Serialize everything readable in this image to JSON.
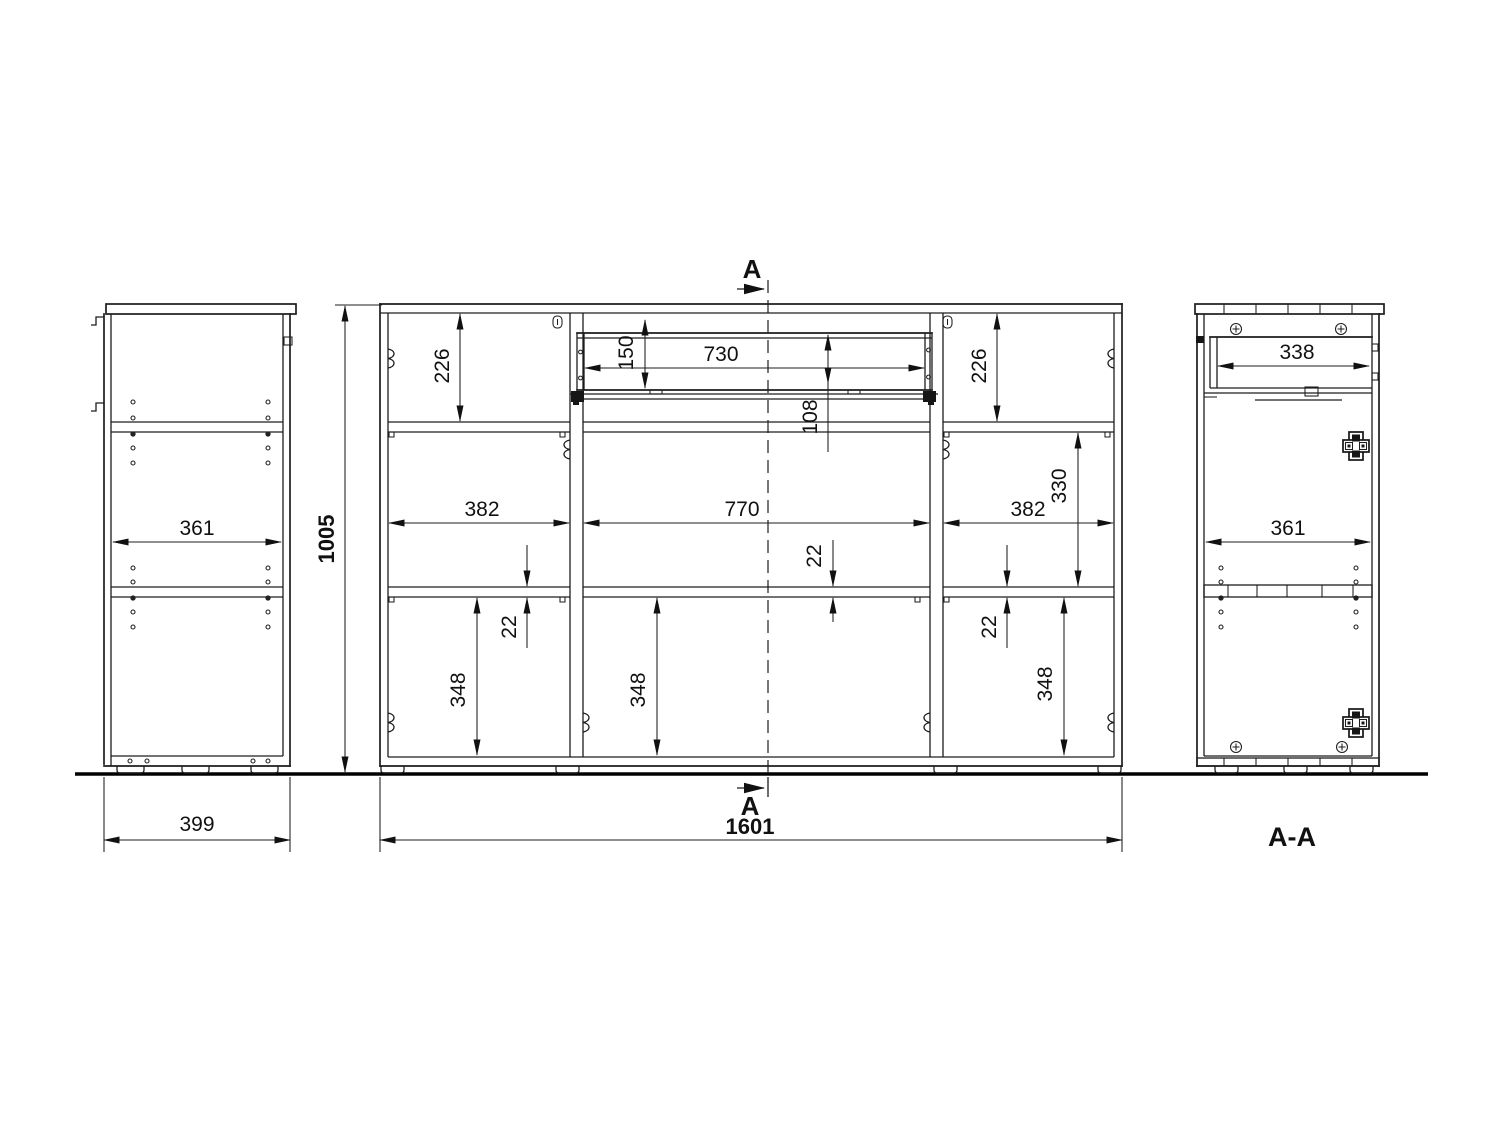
{
  "labels": {
    "section_arrow_top": "A",
    "section_arrow_bottom": "A",
    "section_view": "A-A"
  },
  "dimensions": {
    "side": {
      "inner_width": "361",
      "depth": "399"
    },
    "front": {
      "height": "1005",
      "width": "1601",
      "top_left_cell": "226",
      "top_right_cell": "226",
      "drawer_front_height": "150",
      "drawer_width": "730",
      "drawer_inner_height": "108",
      "mid_right_cell": "330",
      "left_cell_width": "382",
      "mid_cell_width": "770",
      "right_cell_width": "382",
      "shelf_left": "22",
      "shelf_mid": "22",
      "shelf_right": "22",
      "bottom_left_cell": "348",
      "bottom_mid_cell": "348",
      "bottom_right_cell": "348"
    },
    "section": {
      "drawer_width": "338",
      "inner_width": "361"
    }
  }
}
